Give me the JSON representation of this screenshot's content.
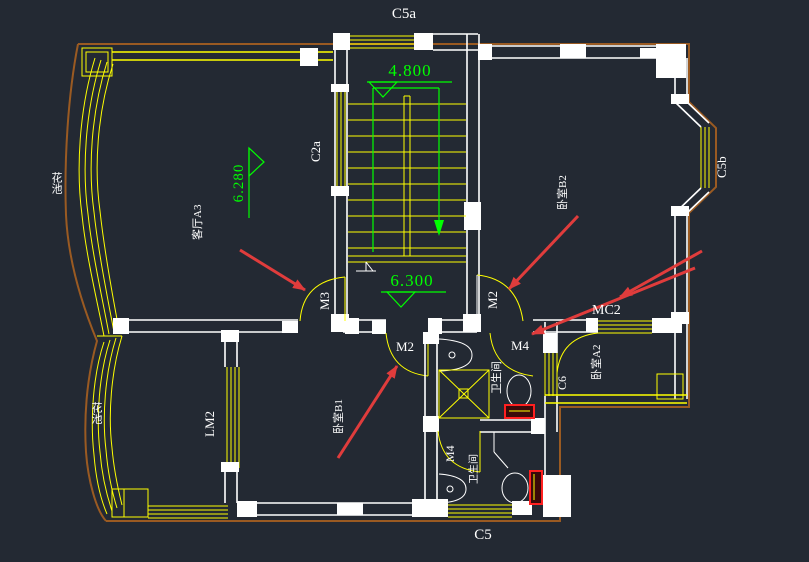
{
  "scene": {
    "type": "cad-floor-plan-canvas",
    "background": "#232933"
  },
  "theme": {
    "background": "#232933",
    "wall_white": "#ffffff",
    "window_yellow": "#ffff00",
    "annotation_green": "#00ff00",
    "callout_arrow_red": "#e03c3c",
    "outer_boundary_brown": "#9a5a22",
    "fixture_red": "#ff2020"
  },
  "levels": {
    "upper_landing": "4.800",
    "hall": "6.300",
    "living_room": "6.280"
  },
  "openings": {
    "c5a": "C5a",
    "c2a": "C2a",
    "c5b": "C5b",
    "c5": "C5",
    "c6": "C6",
    "mc2": "MC2",
    "lm2": "LM2",
    "m2": "M2",
    "m3": "M3",
    "m4": "M4"
  },
  "rooms": {
    "living": "客厅A3",
    "bedroom_right": "卧室B2",
    "bedroom_bottom": "卧室B1",
    "bedroom_small": "卧室A2",
    "bathroom": "卫生间",
    "flower_bed": "花池"
  }
}
